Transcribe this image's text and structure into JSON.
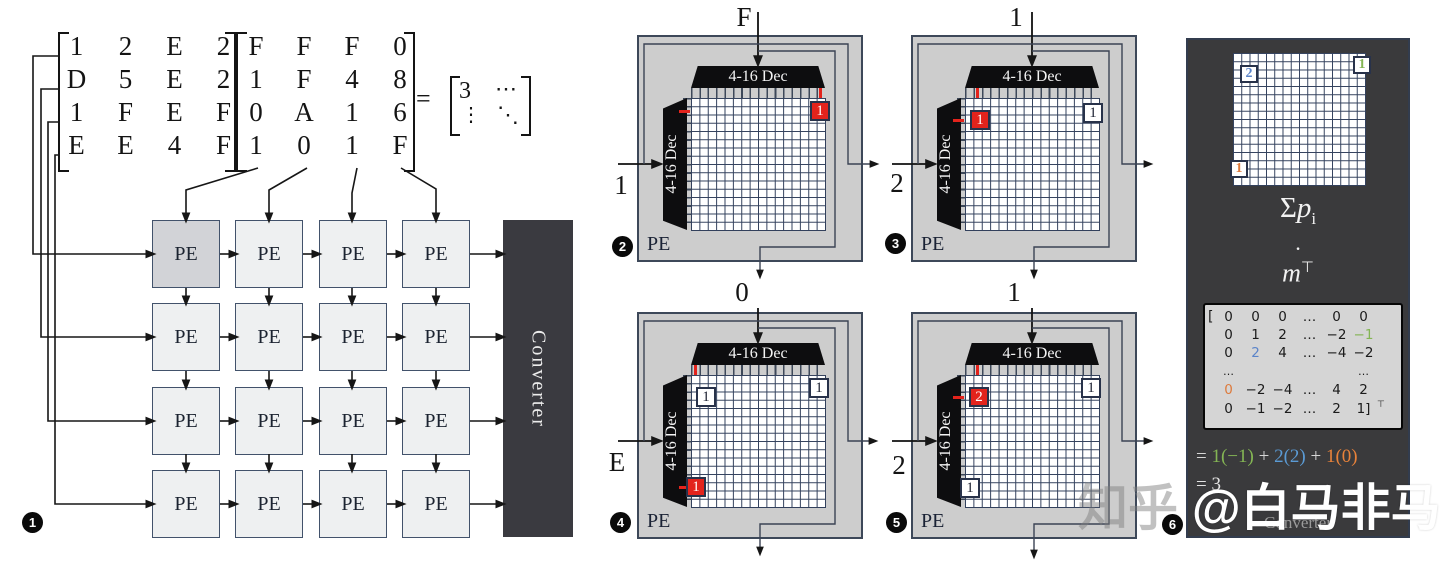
{
  "s1": {
    "matrix_a": [
      [
        "1",
        "2",
        "E",
        "2"
      ],
      [
        "D",
        "5",
        "E",
        "2"
      ],
      [
        "1",
        "F",
        "E",
        "F"
      ],
      [
        "E",
        "E",
        "4",
        "F"
      ]
    ],
    "matrix_b": [
      [
        "F",
        "F",
        "F",
        "0"
      ],
      [
        "1",
        "F",
        "4",
        "8"
      ],
      [
        "0",
        "A",
        "1",
        "6"
      ],
      [
        "1",
        "0",
        "1",
        "F"
      ]
    ],
    "equals": "=",
    "result": {
      "tl": "3",
      "tr": "⋯",
      "bl": "⋮",
      "br": "⋱"
    },
    "pe": "PE",
    "converter": "Converter",
    "badge": "1"
  },
  "panels": [
    {
      "badge": "2",
      "pe": "PE",
      "dec_top": "4-16 Dec",
      "dec_left": "4-16 Dec",
      "in_top": "F",
      "in_left": "1",
      "cells": [
        {
          "v": "1"
        }
      ]
    },
    {
      "badge": "3",
      "pe": "PE",
      "dec_top": "4-16 Dec",
      "dec_left": "4-16 Dec",
      "in_top": "1",
      "in_left": "2",
      "cells": [
        {
          "v": "1"
        },
        {
          "v": "1"
        }
      ]
    },
    {
      "badge": "4",
      "pe": "PE",
      "dec_top": "4-16 Dec",
      "dec_left": "4-16 Dec",
      "in_top": "0",
      "in_left": "E",
      "cells": [
        {
          "v": "1"
        },
        {
          "v": "1"
        },
        {
          "v": "1"
        }
      ]
    },
    {
      "badge": "5",
      "pe": "PE",
      "dec_top": "4-16 Dec",
      "dec_left": "4-16 Dec",
      "in_top": "1",
      "in_left": "2",
      "cells": [
        {
          "v": "2"
        },
        {
          "v": "1"
        },
        {
          "v": "1"
        }
      ]
    }
  ],
  "p6": {
    "badge": "6",
    "cells": [
      {
        "v": "2"
      },
      {
        "v": "1"
      },
      {
        "v": "1"
      }
    ],
    "sum_sigma": "Σ",
    "sum_p": "p",
    "sum_sub": "i",
    "dot": "·",
    "m": "m",
    "transpose": "⊤",
    "bracket_open": "[",
    "matrix": [
      [
        "0",
        "0",
        "0",
        "…",
        "0",
        "0"
      ],
      [
        "0",
        "1",
        "2",
        "…",
        "−2",
        "−1"
      ],
      [
        "0",
        "2",
        "4",
        "…",
        "−4",
        "−2"
      ],
      [
        "…",
        "",
        "",
        "",
        "",
        "…"
      ],
      [
        "0",
        "−2",
        "−4",
        "…",
        "4",
        "2"
      ],
      [
        "0",
        "−1",
        "−2",
        "…",
        "2",
        "1]"
      ]
    ],
    "eq": {
      "e": "=",
      "t1": "1(−1)",
      "p1": "+",
      "t2": "2(2)",
      "p2": "+",
      "t3": "1(0)",
      "line2": "= 3"
    },
    "converter": "Converter"
  },
  "watermark": {
    "site": "知乎 ",
    "handle": "@白马非马"
  }
}
